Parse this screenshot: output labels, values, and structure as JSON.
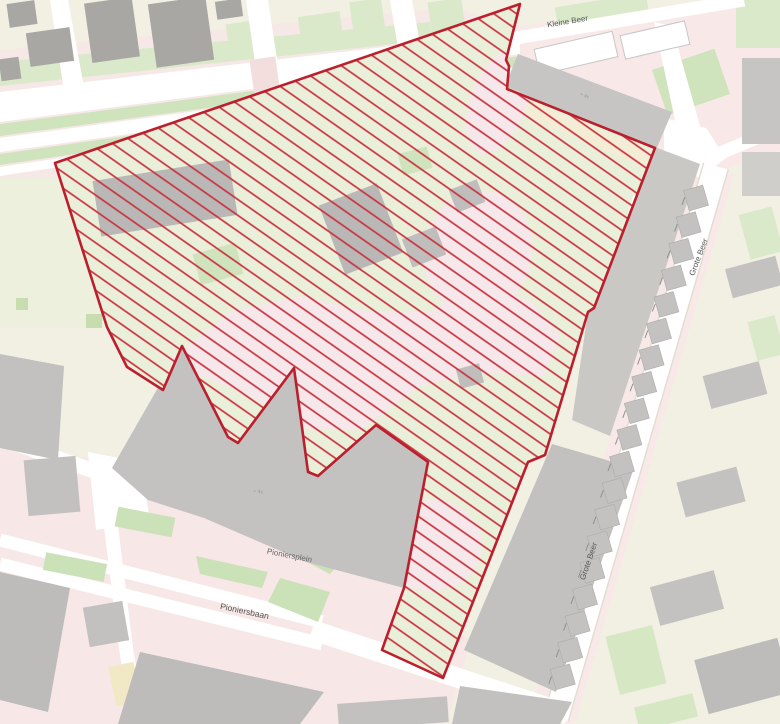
{
  "page": {
    "width": 780,
    "height": 724,
    "background": "#f2efe3"
  },
  "palette": {
    "land": "#f2efe3",
    "pink": "#f7e8e8",
    "road": "#ffffff",
    "grass_light": "#d9e9c9",
    "grass_mid": "#cfe3bd",
    "grass_dark": "#c7ddb0",
    "building": "#c3c2c0",
    "building_dark": "#a9a7a4",
    "building_inner": "#b9b8b6",
    "site_base": "#e9efd9",
    "hatch_red": "#c93340",
    "border_red": "#bb1f2d",
    "label_grey": "#555555",
    "microlabel_grey": "#9a9a9a"
  },
  "site": {
    "points": "520,4 506,60 509,66 507,89 655,148 594,308 588,312 545,455 528,462 443,678 382,650 404,588 428,462 376,425 318,476 308,472 294,368 238,443 228,437 182,346 163,390 127,367 107,327 55,163",
    "border_color": "#bb1f2d",
    "border_width": 2.6,
    "hatch": {
      "color": "#c93340",
      "spacing": 13,
      "angle": 35,
      "line_width": 1.7
    }
  },
  "labels": [
    {
      "id": "street-kleine-beer",
      "text": "Kleine Beer",
      "x": 568,
      "y": 24,
      "r": -9.5,
      "fs": 8,
      "c": "#555555"
    },
    {
      "id": "street-grote-beer-1",
      "text": "Grote Beer",
      "x": 701,
      "y": 258,
      "r": -69,
      "fs": 8,
      "c": "#555555"
    },
    {
      "id": "street-grote-beer-2",
      "text": "Grote Beer",
      "x": 591,
      "y": 562,
      "r": -71,
      "fs": 8,
      "c": "#555555"
    },
    {
      "id": "place-pioniersplein",
      "text": "Pioniersplein",
      "x": 289,
      "y": 558,
      "r": 11,
      "fs": 8,
      "c": "#666666"
    },
    {
      "id": "street-pioniersbaan",
      "text": "Pioniersbaan",
      "x": 244,
      "y": 614,
      "r": 12,
      "fs": 8.5,
      "c": "#555555"
    },
    {
      "id": "building-note-mall",
      "text": "+ 4x",
      "x": 258,
      "y": 493,
      "r": 6,
      "fs": 5,
      "c": "#9a9a9a"
    },
    {
      "id": "building-note-block",
      "text": "+ 4x",
      "x": 584,
      "y": 97,
      "r": 21,
      "fs": 5,
      "c": "#9a9a9a"
    }
  ],
  "houses": {
    "x": 696,
    "y": 198,
    "dx": -7.4,
    "dy": 26.6,
    "n": 19,
    "w": 20,
    "h": 21,
    "rot": -16,
    "f": "#c3c2c0",
    "s": "#adacaa",
    "tick": {
      "ox": -14,
      "oy": 7,
      "len": 8,
      "color": "#909090",
      "w": 1,
      "rot": -70
    }
  },
  "shapes": [
    {
      "n": "land-background",
      "t": "rect",
      "x": 0,
      "y": 0,
      "w": 780,
      "h": 724,
      "f": "#f2efe3"
    },
    {
      "n": "pedestrian-boulevard",
      "t": "poly",
      "p": "0,50 455,7 545,40 545,100 0,195",
      "f": "#f7e8e8"
    },
    {
      "n": "pedestrian-plaza",
      "t": "poly",
      "p": "0,448 120,462 205,478 320,520 408,585 470,642 448,718 330,724 0,724",
      "f": "#f7e7e7"
    },
    {
      "n": "pedestrian-kleinebeer",
      "t": "poly",
      "p": "498,28 780,0 780,150 700,178 640,160 500,60",
      "f": "#f8e9e8"
    },
    {
      "n": "pedestrian-grotebeer",
      "t": "line",
      "x1": 712,
      "y1": 168,
      "x2": 552,
      "y2": 720,
      "w": 46,
      "f": "#f8e9e8"
    },
    {
      "n": "grass-north-band",
      "t": "poly",
      "p": "0,62 430,22 432,40 0,86",
      "f": "#d9e9c9"
    },
    {
      "n": "grass-top-1",
      "t": "rect",
      "x": 300,
      "y": 14,
      "w": 42,
      "h": 34,
      "r": -8,
      "f": "#d9e9c9"
    },
    {
      "n": "grass-top-2",
      "t": "rect",
      "x": 352,
      "y": 0,
      "w": 32,
      "h": 42,
      "r": -8,
      "f": "#d9e9c9"
    },
    {
      "n": "grass-top-3",
      "t": "rect",
      "x": 430,
      "y": 0,
      "w": 34,
      "h": 38,
      "r": -8,
      "f": "#d9e9c9"
    },
    {
      "n": "grass-median-1",
      "t": "poly",
      "p": "0,124 520,56 520,66 0,136",
      "f": "#cfe3bd"
    },
    {
      "n": "grass-median-2",
      "t": "poly",
      "p": "0,154 520,80 520,89 0,165",
      "f": "#cfe3bd"
    },
    {
      "n": "grass-left-field",
      "t": "rect",
      "x": 0,
      "y": 178,
      "w": 112,
      "h": 150,
      "f": "#edf0dc"
    },
    {
      "n": "grass-left-dot-1",
      "t": "rect",
      "x": 86,
      "y": 314,
      "w": 16,
      "h": 14,
      "f": "#c7ddb0"
    },
    {
      "n": "grass-left-dot-2",
      "t": "rect",
      "x": 16,
      "y": 298,
      "w": 12,
      "h": 12,
      "f": "#c7ddb0"
    },
    {
      "n": "grass-left-dot-3",
      "t": "rect",
      "x": 104,
      "y": 170,
      "w": 18,
      "h": 34,
      "f": "#c7ddb0"
    },
    {
      "n": "grass-topleft",
      "t": "rect",
      "x": 228,
      "y": 22,
      "w": 34,
      "h": 36,
      "r": -8,
      "f": "#d9e9c9"
    },
    {
      "n": "grass-topright-1",
      "t": "rect",
      "x": 556,
      "y": 0,
      "w": 92,
      "h": 22,
      "r": -9,
      "f": "#d9e9c9"
    },
    {
      "n": "grass-topright-2",
      "t": "rect",
      "x": 658,
      "y": 58,
      "w": 66,
      "h": 48,
      "r": -19,
      "f": "#cfe3bd"
    },
    {
      "n": "grass-topright-3",
      "t": "rect",
      "x": 736,
      "y": 0,
      "w": 44,
      "h": 48,
      "f": "#d9e9c9"
    },
    {
      "n": "grass-east-1",
      "t": "rect",
      "x": 744,
      "y": 210,
      "w": 34,
      "h": 46,
      "r": -15,
      "f": "#d9e9c9"
    },
    {
      "n": "grass-east-2",
      "t": "rect",
      "x": 752,
      "y": 318,
      "w": 28,
      "h": 40,
      "r": -15,
      "f": "#d9e9c9"
    },
    {
      "n": "grass-southeast-1",
      "t": "rect",
      "x": 612,
      "y": 630,
      "w": 48,
      "h": 60,
      "r": -14,
      "f": "#d6e7c4"
    },
    {
      "n": "grass-southeast-2",
      "t": "rect",
      "x": 636,
      "y": 700,
      "w": 60,
      "h": 24,
      "r": -14,
      "f": "#d6e7c4"
    },
    {
      "n": "road-boulevard-north",
      "t": "poly",
      "p": "0,92 520,31 520,54 0,122",
      "f": "#ffffff"
    },
    {
      "n": "road-boulevard-mid",
      "t": "poly",
      "p": "0,138 520,67 520,79 0,152",
      "f": "#ffffff"
    },
    {
      "n": "road-boulevard-south",
      "t": "poly",
      "p": "0,167 520,90 520,97 0,176",
      "f": "#ffffff"
    },
    {
      "n": "road-vertical-1",
      "t": "poly",
      "p": "50,0 68,0 86,98 66,104",
      "f": "#ffffff"
    },
    {
      "n": "road-vertical-2",
      "t": "poly",
      "p": "246,0 268,0 282,92 260,98",
      "f": "#ffffff"
    },
    {
      "n": "road-vertical-3",
      "t": "poly",
      "p": "390,0 412,0 426,76 404,84",
      "f": "#ffffff"
    },
    {
      "n": "crossing-refuge-1",
      "t": "rect",
      "x": 252,
      "y": 58,
      "w": 26,
      "h": 38,
      "r": -8,
      "f": "#f3dede"
    },
    {
      "n": "crossing-refuge-2",
      "t": "rect",
      "x": 398,
      "y": 48,
      "w": 26,
      "h": 34,
      "r": -8,
      "f": "#f3dede"
    },
    {
      "n": "road-kleine-beer",
      "t": "line",
      "x1": 504,
      "y1": 40,
      "x2": 744,
      "y2": 0,
      "w": 13,
      "f": "#ffffff"
    },
    {
      "n": "road-stub-north",
      "t": "poly",
      "p": "654,22 672,26 700,126 678,134",
      "f": "#ffffff"
    },
    {
      "n": "road-junction-ne",
      "t": "poly",
      "p": "664,118 706,128 726,158 700,178 664,156",
      "f": "#ffffff"
    },
    {
      "n": "road-to-east-edge",
      "t": "line",
      "x1": 704,
      "y1": 160,
      "x2": 780,
      "y2": 128,
      "w": 13,
      "f": "#ffffff"
    },
    {
      "n": "road-grote-beer-casing",
      "t": "line",
      "x1": 716,
      "y1": 166,
      "x2": 556,
      "y2": 718,
      "w": 27,
      "f": "#e3ddd2"
    },
    {
      "n": "road-grote-beer",
      "t": "line",
      "x1": 716,
      "y1": 166,
      "x2": 556,
      "y2": 718,
      "w": 24,
      "f": "#ffffff"
    },
    {
      "n": "road-pioniersbaan-1",
      "t": "line",
      "x1": 0,
      "y1": 540,
      "x2": 322,
      "y2": 622,
      "w": 13,
      "f": "#ffffff"
    },
    {
      "n": "road-pioniersbaan-2",
      "t": "line",
      "x1": 0,
      "y1": 564,
      "x2": 322,
      "y2": 644,
      "w": 13,
      "f": "#ffffff"
    },
    {
      "n": "road-pioniersbaan-east",
      "t": "line",
      "x1": 312,
      "y1": 630,
      "x2": 568,
      "y2": 714,
      "w": 20,
      "f": "#ffffff"
    },
    {
      "n": "road-vertical-south-1",
      "t": "line",
      "x1": 104,
      "y1": 470,
      "x2": 126,
      "y2": 648,
      "w": 14,
      "f": "#ffffff"
    },
    {
      "n": "road-vertical-south-2",
      "t": "line",
      "x1": 126,
      "y1": 648,
      "x2": 138,
      "y2": 724,
      "w": 14,
      "f": "#ffffff"
    },
    {
      "n": "road-junction-sw",
      "t": "poly",
      "p": "88,452 140,462 150,520 96,530",
      "f": "#ffffff"
    },
    {
      "n": "road-left-connector",
      "t": "line",
      "x1": 0,
      "y1": 438,
      "x2": 108,
      "y2": 476,
      "w": 15,
      "f": "#ffffff"
    },
    {
      "n": "grass-plaza-1",
      "t": "rect",
      "x": 44,
      "y": 558,
      "w": 62,
      "h": 18,
      "r": 11,
      "f": "#cbe1b8"
    },
    {
      "n": "grass-plaza-2",
      "t": "rect",
      "x": 116,
      "y": 512,
      "w": 58,
      "h": 20,
      "r": 11,
      "f": "#cbe1b8"
    },
    {
      "n": "grass-plaza-3",
      "t": "poly",
      "p": "196,556 268,572 262,588 200,574",
      "f": "#cbe1b8"
    },
    {
      "n": "grass-plaza-4",
      "t": "poly",
      "p": "282,538 342,560 330,574 288,552",
      "f": "#cbe1b8"
    },
    {
      "n": "grass-plaza-5",
      "t": "poly",
      "p": "280,578 330,592 318,622 268,602",
      "f": "#cbe1b8"
    },
    {
      "n": "footpath-west-of-site",
      "t": "line",
      "x1": 62,
      "y1": 170,
      "x2": 122,
      "y2": 356,
      "w": 5,
      "f": "#ffffff"
    },
    {
      "n": "building-topleft-1",
      "t": "rect",
      "x": 8,
      "y": 2,
      "w": 28,
      "h": 24,
      "r": -8,
      "f": "#a9a7a4"
    },
    {
      "n": "building-topleft-2",
      "t": "rect",
      "x": 28,
      "y": 30,
      "w": 44,
      "h": 34,
      "r": -8,
      "f": "#a9a7a4"
    },
    {
      "n": "building-topleft-3",
      "t": "rect",
      "x": 0,
      "y": 58,
      "w": 20,
      "h": 22,
      "r": -8,
      "f": "#a9a7a4"
    },
    {
      "n": "building-topleft-4",
      "t": "rect",
      "x": 88,
      "y": 0,
      "w": 48,
      "h": 60,
      "r": -8,
      "f": "#a9a7a4"
    },
    {
      "n": "building-topleft-5",
      "t": "rect",
      "x": 152,
      "y": 0,
      "w": 58,
      "h": 64,
      "r": -8,
      "f": "#a9a7a4"
    },
    {
      "n": "building-topleft-6",
      "t": "rect",
      "x": 216,
      "y": 0,
      "w": 26,
      "h": 18,
      "r": -8,
      "f": "#a9a7a4"
    },
    {
      "n": "building-left-1",
      "t": "poly",
      "p": "0,354 64,366 58,460 0,448",
      "f": "#c2c1bf"
    },
    {
      "n": "building-left-2",
      "t": "rect",
      "x": 26,
      "y": 458,
      "w": 52,
      "h": 56,
      "r": -5,
      "f": "#c2c1bf"
    },
    {
      "n": "building-swblock-1",
      "t": "poly",
      "p": "0,572 70,588 48,712 0,700",
      "f": "#bdbcba"
    },
    {
      "n": "building-swblock-2",
      "t": "rect",
      "x": 86,
      "y": 604,
      "w": 40,
      "h": 40,
      "r": -10,
      "f": "#c2c1bf"
    },
    {
      "n": "building-sw-yellow",
      "t": "rect",
      "x": 112,
      "y": 664,
      "w": 26,
      "h": 40,
      "r": -12,
      "f": "#f1e9c6"
    },
    {
      "n": "building-south-1",
      "t": "poly",
      "p": "140,652 324,692 300,724 118,724",
      "f": "#bdbcba"
    },
    {
      "n": "building-south-2",
      "t": "rect",
      "x": 338,
      "y": 700,
      "w": 110,
      "h": 26,
      "r": -4,
      "f": "#c2c1bf"
    },
    {
      "n": "building-south-3",
      "t": "poly",
      "p": "460,686 572,702 560,724 452,724",
      "f": "#c2c1bf"
    },
    {
      "n": "parking-strip-east",
      "t": "poly",
      "p": "652,146 700,164 610,436 572,420 588,312 594,306",
      "f": "#c9c8c5"
    },
    {
      "n": "building-east-large",
      "t": "poly",
      "p": "552,444 634,468 556,692 464,650",
      "f": "#c2c1bf"
    },
    {
      "n": "building-east-row-1",
      "t": "rect",
      "x": 728,
      "y": 262,
      "w": 52,
      "h": 30,
      "r": -15,
      "f": "#c3c2c0"
    },
    {
      "n": "building-east-row-2",
      "t": "rect",
      "x": 706,
      "y": 368,
      "w": 58,
      "h": 34,
      "r": -15,
      "f": "#c3c2c0"
    },
    {
      "n": "building-east-row-3",
      "t": "rect",
      "x": 680,
      "y": 474,
      "w": 62,
      "h": 36,
      "r": -15,
      "f": "#c3c2c0"
    },
    {
      "n": "building-east-row-4",
      "t": "rect",
      "x": 654,
      "y": 578,
      "w": 66,
      "h": 40,
      "r": -15,
      "f": "#c3c2c0"
    },
    {
      "n": "building-southeast",
      "t": "rect",
      "x": 700,
      "y": 648,
      "w": 86,
      "h": 56,
      "r": -15,
      "f": "#bdbcba"
    },
    {
      "n": "building-white-1",
      "t": "rect",
      "x": 536,
      "y": 40,
      "w": 80,
      "h": 26,
      "r": -13,
      "f": "#ffffff",
      "s": "#c6c6c6",
      "sw": 1
    },
    {
      "n": "building-white-2",
      "t": "rect",
      "x": 622,
      "y": 28,
      "w": 66,
      "h": 24,
      "r": -13,
      "f": "#ffffff",
      "s": "#c6c6c6",
      "sw": 1
    },
    {
      "n": "building-fareast-1",
      "t": "rect",
      "x": 742,
      "y": 58,
      "w": 38,
      "h": 86,
      "f": "#c6c5c3"
    },
    {
      "n": "building-fareast-2",
      "t": "rect",
      "x": 742,
      "y": 152,
      "w": 38,
      "h": 44,
      "f": "#cfcecb"
    },
    {
      "n": "building-kleinebeer-block",
      "t": "poly",
      "p": "505,86 518,54 672,112 656,150",
      "f": "#c6c5c3"
    },
    {
      "n": "building-mall",
      "t": "poly",
      "p": "136,426 182,346 228,437 238,443 294,368 309,473 318,476 376,425 429,462 404,588 306,562 204,518 148,500 112,468",
      "f": "#c3c2c0"
    },
    {
      "n": "site-ground",
      "t": "poly",
      "cl": true,
      "p": "520,4 506,60 509,66 507,89 655,148 594,308 588,312 545,455 528,462 443,678 382,650 404,588 428,462 376,425 318,476 308,472 294,368 238,443 228,437 182,346 163,390 127,367 107,327 55,163",
      "f": "#e9efd9"
    },
    {
      "n": "site-cream-band",
      "t": "poly",
      "cl": true,
      "p": "507,92 652,152 646,168 503,106",
      "f": "#f3edd6"
    },
    {
      "n": "site-path-blob-1",
      "t": "poly",
      "cl": true,
      "p": "168,362 230,312 300,296 368,312 430,312 482,282 532,302 560,336 544,376 482,372 420,386 360,430 310,430 250,396",
      "f": "#f6e7ea"
    },
    {
      "n": "site-path-blob-2",
      "t": "ell",
      "cl": true,
      "cx": 478,
      "cy": 252,
      "rx": 54,
      "ry": 62,
      "r": 14,
      "f": "#f6e7ea"
    },
    {
      "n": "site-path-blob-3",
      "t": "ell",
      "cl": true,
      "cx": 498,
      "cy": 102,
      "rx": 28,
      "ry": 54,
      "r": 20,
      "f": "#f6e7ea"
    },
    {
      "n": "site-path-blob-4",
      "t": "ell",
      "cl": true,
      "cx": 430,
      "cy": 545,
      "rx": 52,
      "ry": 46,
      "f": "#f6e7ea"
    },
    {
      "n": "site-building-1",
      "t": "rect",
      "cl": true,
      "x": 96,
      "y": 170,
      "w": 138,
      "h": 56,
      "r": -9,
      "f": "#b9b8b6"
    },
    {
      "n": "site-building-2",
      "t": "rect",
      "cl": true,
      "x": 330,
      "y": 192,
      "w": 62,
      "h": 74,
      "r": -21,
      "f": "#b9b8b6"
    },
    {
      "n": "site-building-3",
      "t": "rect",
      "cl": true,
      "x": 406,
      "y": 232,
      "w": 36,
      "h": 30,
      "r": -21,
      "f": "#bfbebc"
    },
    {
      "n": "site-building-4",
      "t": "rect",
      "cl": true,
      "x": 452,
      "y": 184,
      "w": 30,
      "h": 24,
      "r": -21,
      "f": "#bfbebc"
    },
    {
      "n": "site-building-5",
      "t": "rect",
      "cl": true,
      "x": 458,
      "y": 366,
      "w": 24,
      "h": 20,
      "r": -15,
      "f": "#bfbebc"
    },
    {
      "n": "site-grass-1",
      "t": "rect",
      "cl": true,
      "x": 196,
      "y": 248,
      "w": 44,
      "h": 32,
      "r": -15,
      "f": "#cfe3bd"
    },
    {
      "n": "site-grass-2",
      "t": "rect",
      "cl": true,
      "x": 400,
      "y": 150,
      "w": 30,
      "h": 22,
      "r": -15,
      "f": "#cfe3bd"
    },
    {
      "n": "site-footpath",
      "t": "line",
      "cl": true,
      "x1": 636,
      "y1": 196,
      "x2": 600,
      "y2": 330,
      "w": 6,
      "f": "#ffffff"
    }
  ]
}
